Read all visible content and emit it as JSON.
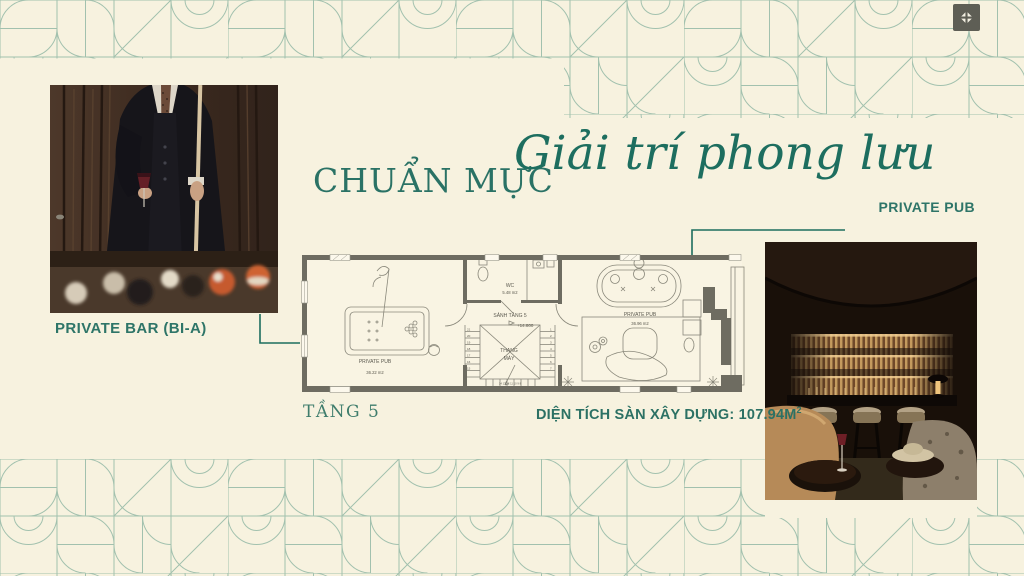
{
  "meta": {
    "bg_color": "#f7f2df",
    "accent_color": "#1e6f60",
    "pattern_color": "#a2c1ae",
    "wall_color": "#6e6c61"
  },
  "toolbar": {
    "fullscreen_icon": "compress-icon"
  },
  "title": {
    "serif": "CHUẨN MỰC",
    "script": "Giải trí phong lưu"
  },
  "photos": {
    "bar_label": "PRIVATE BAR (BI-A)",
    "pub_label": "PRIVATE PUB"
  },
  "plan": {
    "wc_name": "WC",
    "wc_area": "5.48 m2",
    "hall_name": "SẢNH TẦNG 5",
    "hall_level": "+14.800",
    "lift_line1": "THANG",
    "lift_line2": "MÁY",
    "room_left_name": "PRIVATE PUB",
    "room_left_area": "36.22 m2",
    "room_right_name": "PRIVATE PUB",
    "room_right_area": "36.96 m2",
    "stairs_left": [
      "21",
      "20",
      "19",
      "18",
      "17",
      "16",
      "15"
    ],
    "stairs_right": [
      "1",
      "2",
      "3",
      "4",
      "5",
      "6",
      "7"
    ],
    "stairs_bottom": "14 13 12 11 10 9 8"
  },
  "footer": {
    "floor": "TẦNG 5",
    "area_text": "DIỆN TÍCH SÀN XÂY DỰNG: 107.94M",
    "area_sup": "2"
  }
}
